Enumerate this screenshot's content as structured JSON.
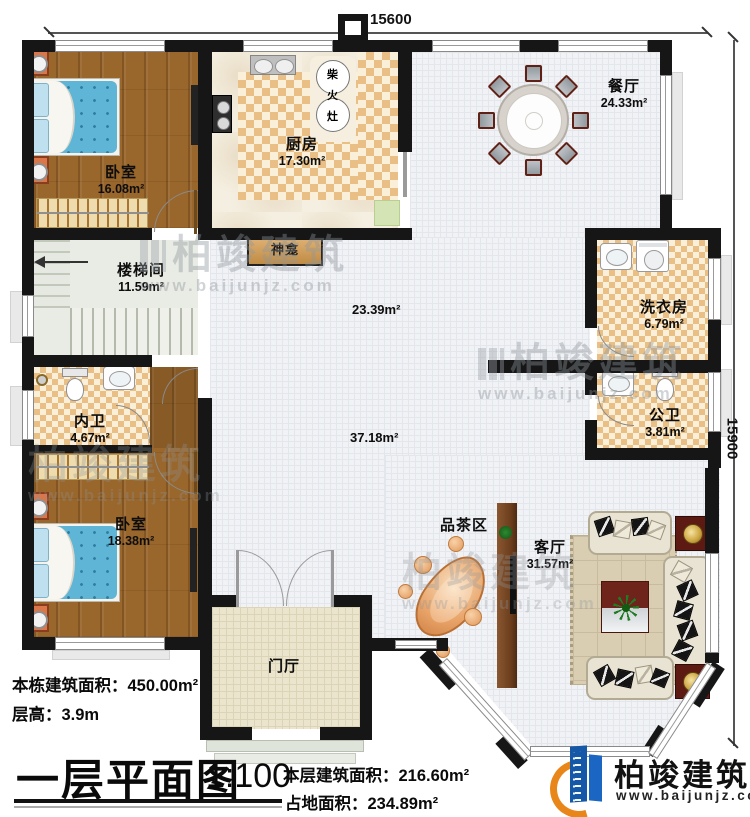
{
  "dimensions": {
    "top": "15600",
    "right": "15900"
  },
  "rooms": {
    "bedroom1": {
      "name": "卧室",
      "area": "16.08m²"
    },
    "kitchen": {
      "name": "厨房",
      "area": "17.30m²"
    },
    "dining": {
      "name": "餐厅",
      "area": "24.33m²"
    },
    "stairwell": {
      "name": "楼梯间",
      "area": "11.59m²"
    },
    "inner_bath": {
      "name": "内卫",
      "area": "4.67m²"
    },
    "bedroom2": {
      "name": "卧室",
      "area": "18.38m²"
    },
    "laundry": {
      "name": "洗衣房",
      "area": "6.79m²"
    },
    "public_bath": {
      "name": "公卫",
      "area": "3.81m²"
    },
    "tea_area": {
      "name": "品茶区"
    },
    "living": {
      "name": "客厅",
      "area": "31.57m²"
    },
    "entry_hall": {
      "name": "门厅"
    },
    "shrine": {
      "name": "神龛"
    },
    "open_area_1": "23.39m²",
    "open_area_2": "37.18m²",
    "firewood_stove": {
      "char1": "柴",
      "char2": "火",
      "char3": "灶"
    }
  },
  "footer": {
    "building_total_area": "本栋建筑面积：450.00m²",
    "floor_height": "层高：3.9m",
    "plan_title": "一层平面图",
    "scale": "1:100",
    "floor_area": "本层建筑面积：216.60m²",
    "footprint_area": "占地面积：234.89m²"
  },
  "logo": {
    "company": "柏竣建筑",
    "website": "www.baijunjz.com"
  },
  "watermark": {
    "company": "柏竣建筑",
    "website": "www.baijunjz.com"
  },
  "colors": {
    "wall": "#161616",
    "wood_floor": "#99662b",
    "checker_tile": "#eabf85",
    "bed_blue": "#5eb5d6",
    "accent_red": "#5d1a12",
    "logo_blue": "#1558a8",
    "logo_orange": "#e8861a"
  }
}
